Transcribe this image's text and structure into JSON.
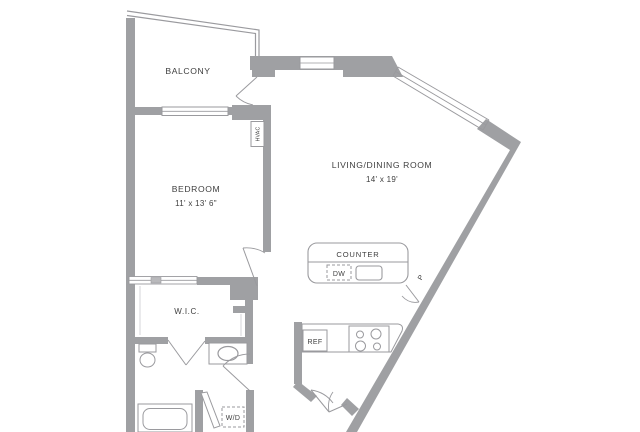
{
  "floorplan": {
    "rooms": {
      "balcony": {
        "label": "BALCONY",
        "dimensions": ""
      },
      "bedroom": {
        "label": "BEDROOM",
        "dimensions": "11' x 13' 6\""
      },
      "living_dining": {
        "label": "LIVING/DINING ROOM",
        "dimensions": "14' x 19'"
      },
      "wic": {
        "label": "W.I.C.",
        "dimensions": ""
      }
    },
    "fixtures": {
      "counter": {
        "label": "COUNTER"
      },
      "dishwasher": {
        "label": "DW"
      },
      "pantry": {
        "label": "P"
      },
      "refrigerator": {
        "label": "REF"
      },
      "washer_dryer": {
        "label": "W/D"
      },
      "hvac": {
        "label": "HVAC"
      }
    },
    "colors": {
      "wall": "#9fa0a3",
      "line": "#9a9a9e",
      "text": "#404040",
      "background": "#ffffff"
    }
  }
}
